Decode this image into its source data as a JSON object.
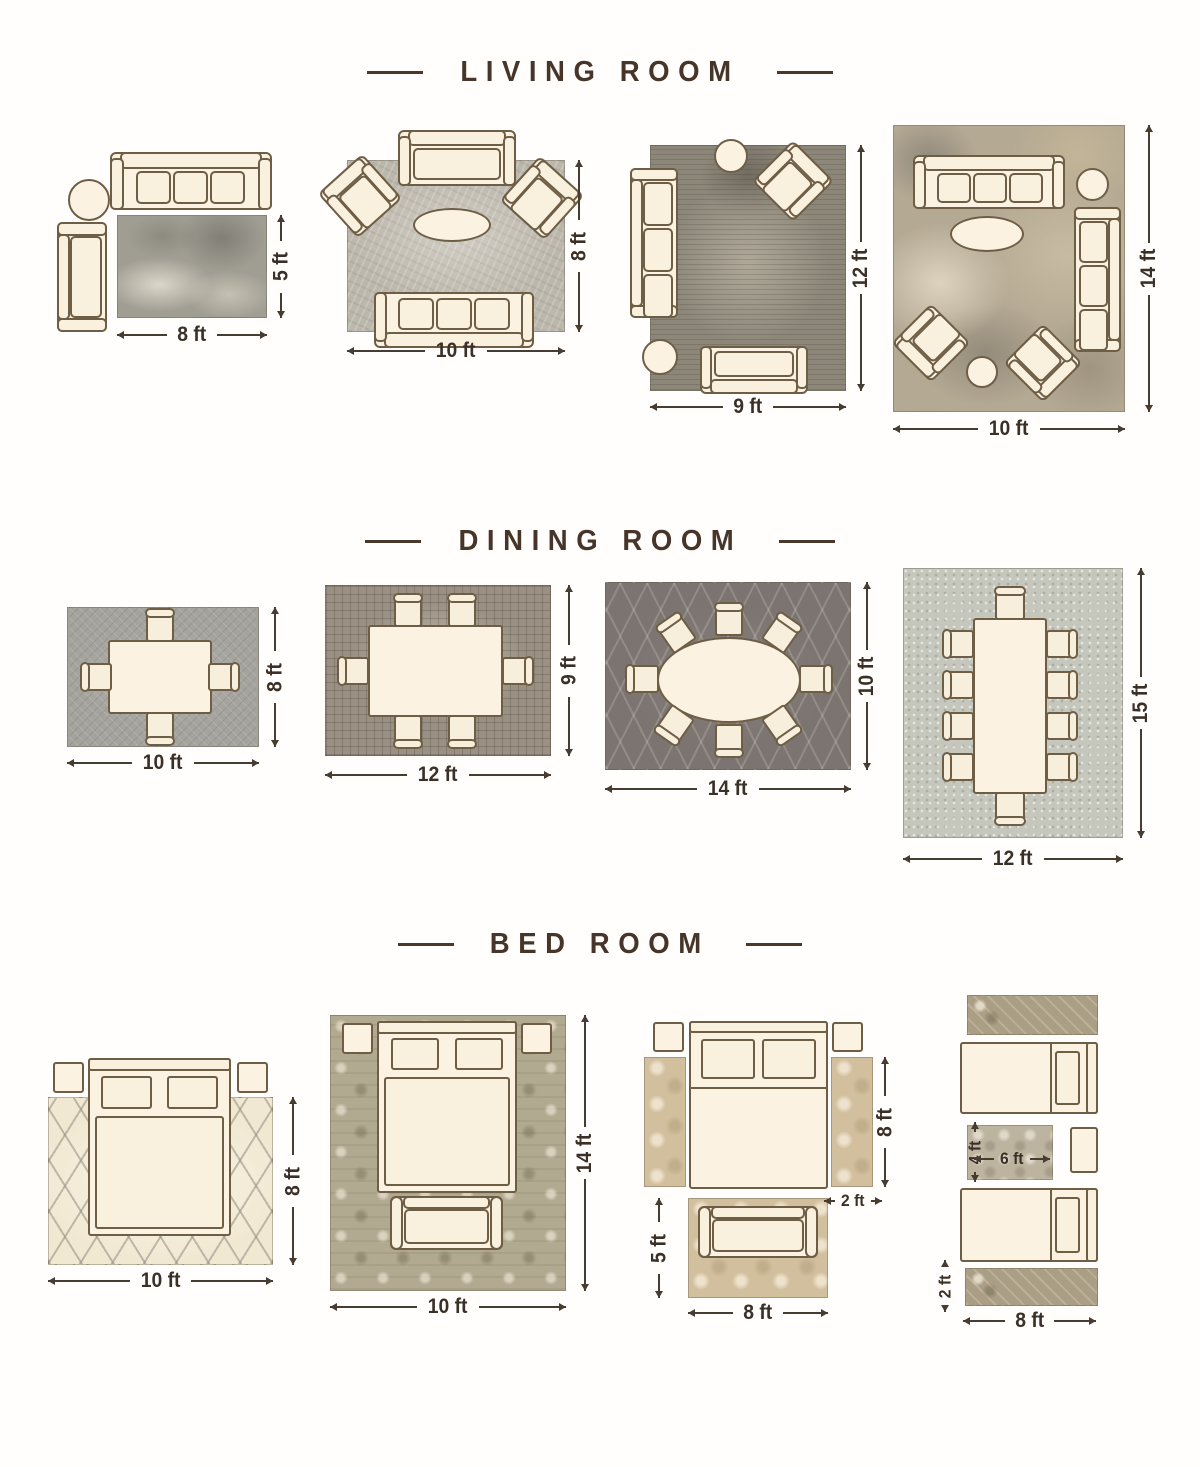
{
  "page": {
    "background": "#ffffff"
  },
  "palette": {
    "title_text": "#463528",
    "dimension_text": "#3b3027",
    "furniture_fill": "#fbf2e2",
    "furniture_outline": "#6e5e46"
  },
  "sections": [
    {
      "title": "LIVING ROOM",
      "layouts": [
        {
          "width_label": "8 ft",
          "height_label": "5 ft"
        },
        {
          "width_label": "10 ft",
          "height_label": "8 ft"
        },
        {
          "width_label": "9 ft",
          "height_label": "12 ft"
        },
        {
          "width_label": "10 ft",
          "height_label": "14 ft"
        }
      ]
    },
    {
      "title": "DINING ROOM",
      "layouts": [
        {
          "width_label": "10 ft",
          "height_label": "8 ft"
        },
        {
          "width_label": "12 ft",
          "height_label": "9 ft"
        },
        {
          "width_label": "14 ft",
          "height_label": "10 ft"
        },
        {
          "width_label": "12 ft",
          "height_label": "15 ft"
        }
      ]
    },
    {
      "title": "BED ROOM",
      "layouts": [
        {
          "width_label": "10 ft",
          "height_label": "8 ft"
        },
        {
          "width_label": "10 ft",
          "height_label": "14 ft"
        },
        {
          "runner_height_label": "8 ft",
          "runner_width_label": "2 ft",
          "accent_rug_height_label": "5 ft",
          "accent_rug_width_label": "8 ft"
        },
        {
          "center_rug_height_label": "4 ft",
          "center_rug_width_label": "6 ft",
          "runner_height_label": "2 ft",
          "runner_width_label": "8 ft"
        }
      ]
    }
  ]
}
